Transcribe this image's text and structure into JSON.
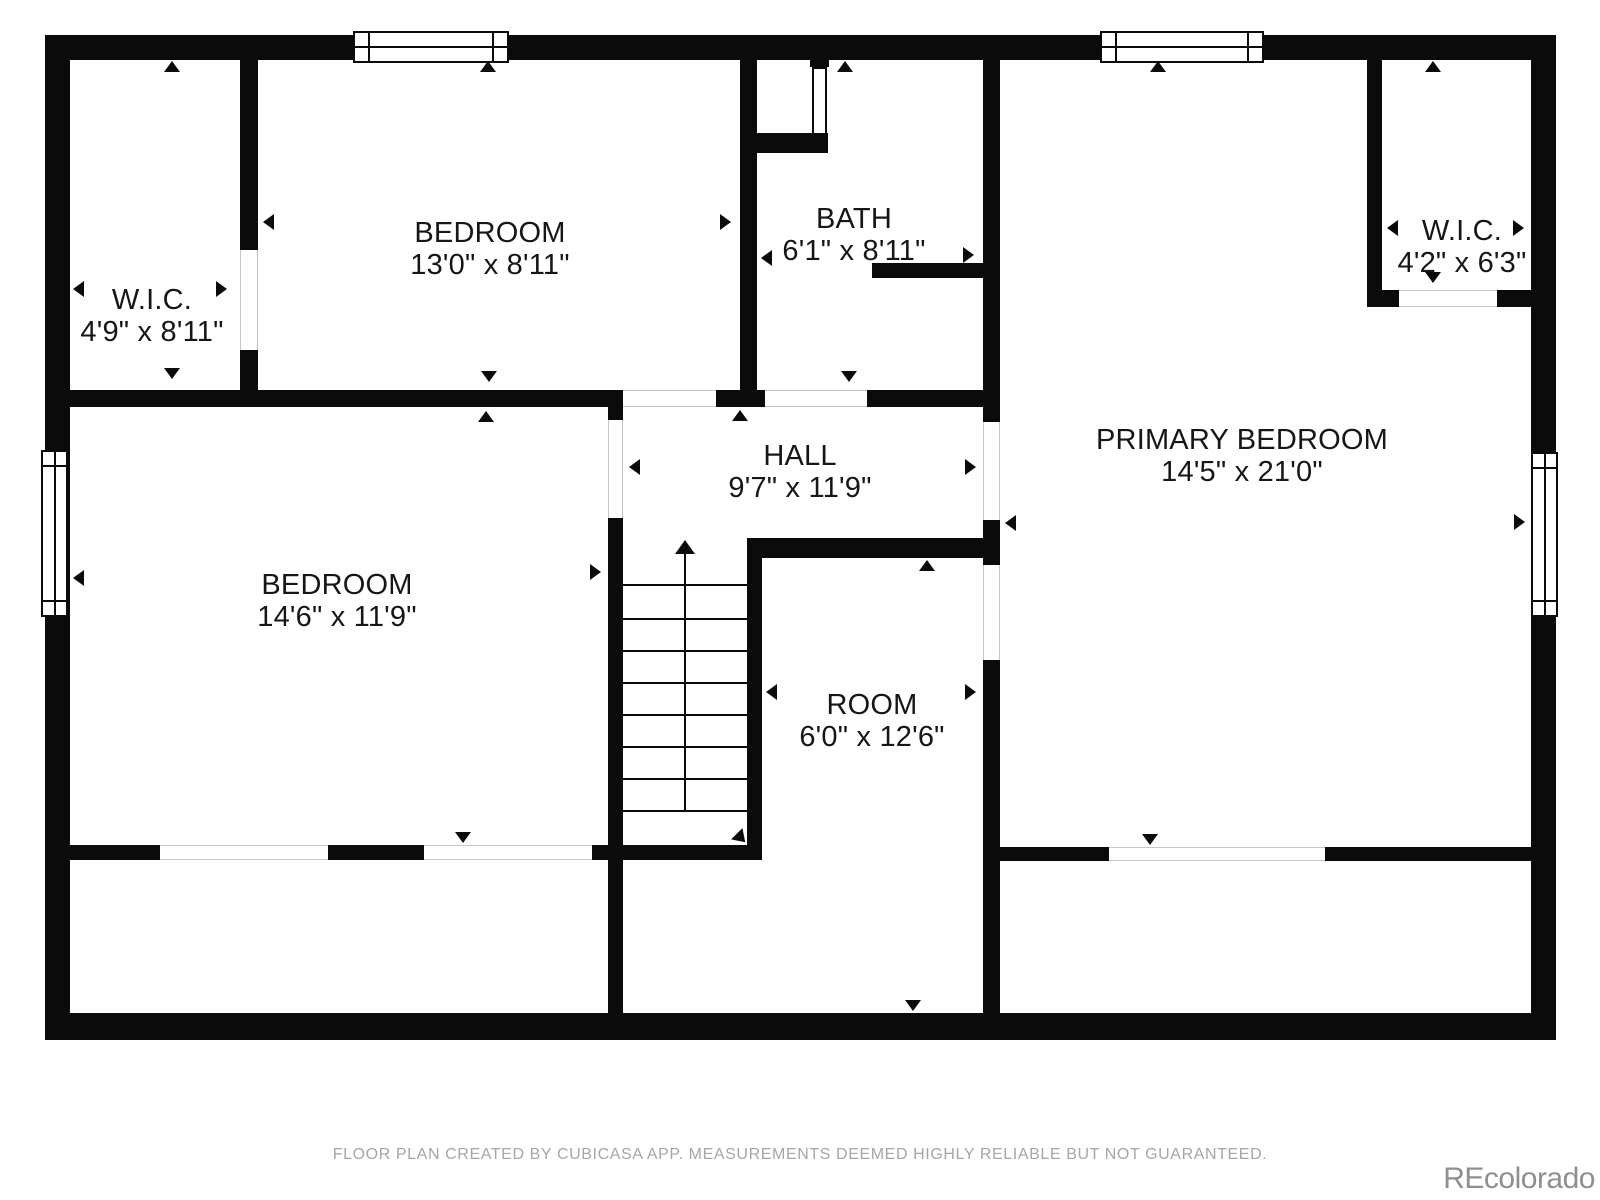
{
  "rooms": [
    {
      "id": "wic-top-left",
      "name": "W.I.C.",
      "dims": "4'9\" x 8'11\""
    },
    {
      "id": "bedroom-top",
      "name": "BEDROOM",
      "dims": "13'0\" x 8'11\""
    },
    {
      "id": "bath",
      "name": "BATH",
      "dims": "6'1\" x 8'11\""
    },
    {
      "id": "wic-top-right",
      "name": "W.I.C.",
      "dims": "4'2\" x 6'3\""
    },
    {
      "id": "primary-bedroom",
      "name": "PRIMARY BEDROOM",
      "dims": "14'5\" x 21'0\""
    },
    {
      "id": "hall",
      "name": "HALL",
      "dims": "9'7\" x 11'9\""
    },
    {
      "id": "bedroom-left",
      "name": "BEDROOM",
      "dims": "14'6\" x 11'9\""
    },
    {
      "id": "room",
      "name": "ROOM",
      "dims": "6'0\" x 12'6\""
    }
  ],
  "footer": {
    "disclaimer": "FLOOR PLAN CREATED BY CUBICASA APP. MEASUREMENTS DEEMED HIGHLY RELIABLE BUT NOT GUARANTEED."
  },
  "watermark": {
    "text": "REcolorado"
  },
  "colors": {
    "wall": "#0b0b0b",
    "room_text": "#161616",
    "disclaimer_text": "#a6a6a6",
    "watermark_text": "#8f8f8f",
    "background": "#ffffff"
  }
}
